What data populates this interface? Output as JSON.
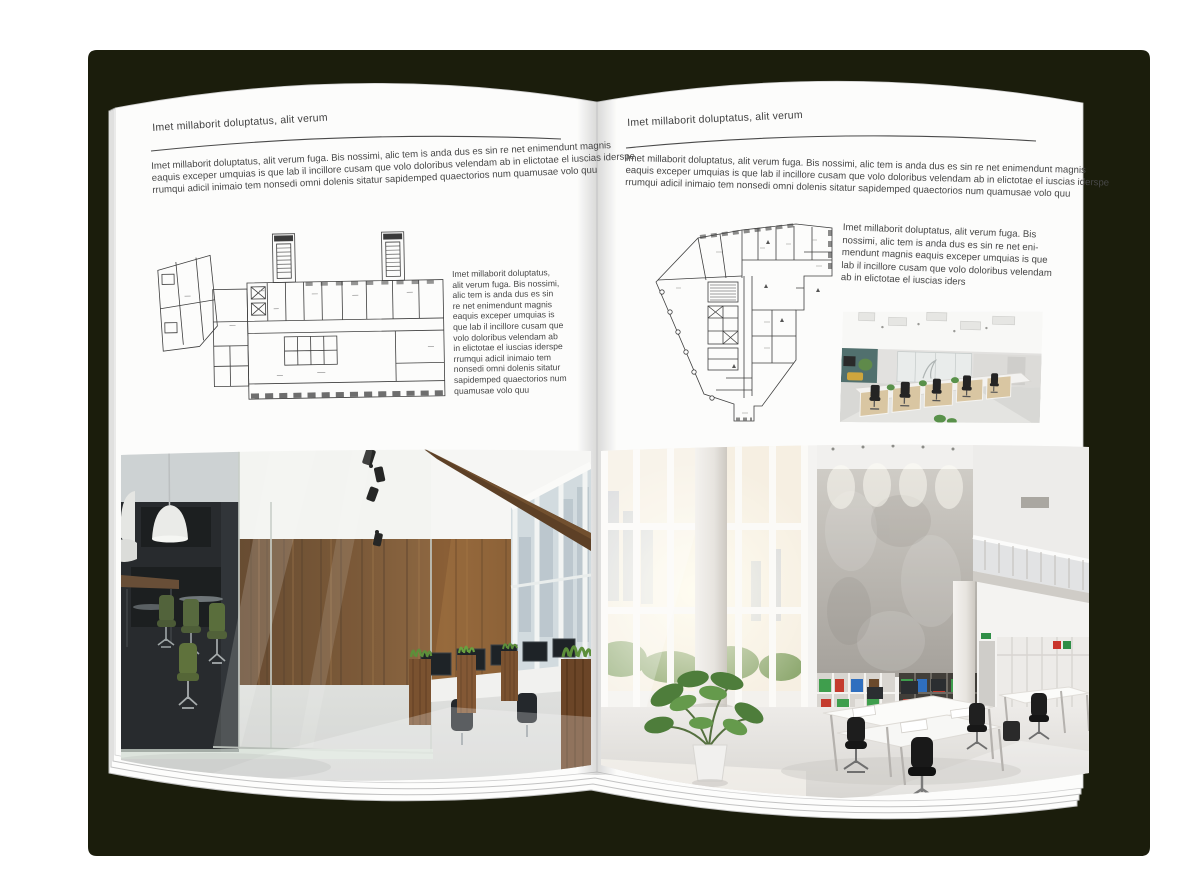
{
  "document": {
    "kind": "architecture brochure spread mockup",
    "cover_color": "#1b1d0c",
    "page_color": "#fcfcfb",
    "text_color": "#474747"
  },
  "page_left": {
    "header": "Imet millaborit doluptatus, alit verum",
    "intro_lines": [
      "Imet millaborit doluptatus, alit verum fuga. Bis nossimi, alic tem is anda dus es sin re net enimendunt magnis",
      "eaquis exceper umquias is que lab il incillore cusam que volo doloribus velendam ab in elictotae el iuscias iderspe",
      "rrumqui adicil inimaio tem nonsedi omni dolenis sitatur sapidemped quaectorios num quamusae volo quu"
    ],
    "side_lines": [
      "Imet millaborit doluptatus,",
      "alit verum fuga. Bis nossimi,",
      "alic tem is anda dus es sin",
      "re net enimendunt magnis",
      "eaquis exceper umquias is",
      "que lab il incillore cusam que",
      "volo doloribus velendam ab",
      "in elictotae el iuscias iderspe",
      "rrumqui adicil inimaio tem",
      "nonsedi omni dolenis sitatur",
      "sapidemped quaectorios num",
      "quamusae volo quu"
    ],
    "floor_plan": {
      "description": "Black line floor plan of an elongated office building with two stair towers on top and an angled left wing"
    },
    "photo": {
      "description": "Loft office interior: dark glass meeting room with green chairs, walnut wood wall, workstations with monitors and wooden grass planters"
    }
  },
  "page_right": {
    "header": "Imet millaborit doluptatus, alit verum",
    "intro_lines": [
      "Imet millaborit doluptatus, alit verum fuga. Bis nossimi, alic tem is anda dus es sin re net enimendunt magnis",
      "eaquis exceper umquias is que lab il incillore cusam que volo doloribus velendam ab in elictotae el iuscias iderspe",
      "rrumqui adicil inimaio tem nonsedi omni dolenis sitatur sapidemped quaectorios num quamusae volo quu"
    ],
    "side_lines": [
      "Imet millaborit doluptatus, alit verum fuga. Bis",
      "nossimi, alic tem is anda dus es sin re net eni-",
      "mendunt magnis eaquis exceper umquias is que",
      "lab il incillore cusam que volo doloribus velendam",
      "ab in elictotae el iuscias iders"
    ],
    "floor_plan": {
      "description": "Black line floor plan of an irregular corner building tapering toward the bottom with a central stair core"
    },
    "photo_small": {
      "description": "Open-plan office with white and light-wood cubicle workstations, black chairs and ceiling light panels"
    },
    "photo": {
      "description": "Bright double-height office: glazed facade, tall concrete wall, shelving with colorful binders, white desks, black chairs and a large plant"
    }
  }
}
